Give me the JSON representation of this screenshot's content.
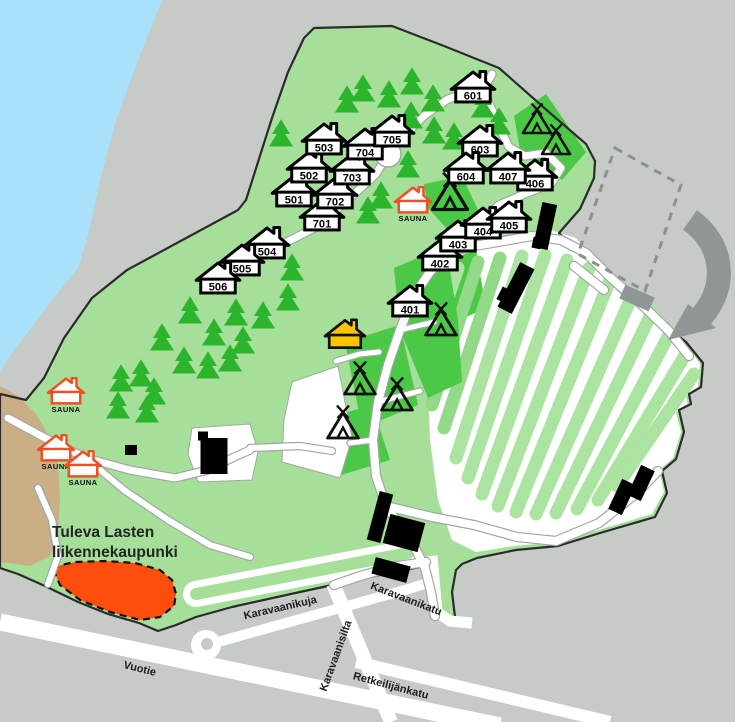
{
  "map": {
    "width": 735,
    "height": 722,
    "colors": {
      "land": "#c6cbc8",
      "water": "#a9e1fb",
      "camp": "#a5df9a",
      "plot": "#4cc847",
      "island": "#abe3a0",
      "island_alt": "#92da88",
      "tree": "#2cb52c",
      "road": "#ffffff",
      "casing": "#a0a8a0",
      "boundary": "#2b2b2b",
      "building": "#000000",
      "beach": "#c9ae86",
      "sauna": "#f04f21",
      "reception": "#fcc400",
      "zone": "#fe4e0e",
      "gray_structure": "#8f9693",
      "dashed": "#8a918e"
    },
    "labels": {
      "sauna": "SAUNA",
      "area": [
        "Tuleva Lasten",
        "liikennekaupunki"
      ],
      "area_x": 52,
      "area_y": 537,
      "area_line_height": 20
    },
    "streets": [
      {
        "name": "Karavaanikuja",
        "x": 281,
        "y": 611,
        "rot": -13
      },
      {
        "name": "Karavaanikatu",
        "x": 405,
        "y": 602,
        "rot": 21
      },
      {
        "name": "Karavaanisilta",
        "x": 339,
        "y": 657,
        "rot": -70
      },
      {
        "name": "Vuotie",
        "x": 139,
        "y": 672,
        "rot": 14
      },
      {
        "name": "Retkeilijänkatu",
        "x": 390,
        "y": 689,
        "rot": 15
      }
    ],
    "cabins": [
      {
        "n": "501",
        "x": 294,
        "y": 191
      },
      {
        "n": "502",
        "x": 309,
        "y": 167
      },
      {
        "n": "503",
        "x": 324,
        "y": 139
      },
      {
        "n": "504",
        "x": 267,
        "y": 243
      },
      {
        "n": "505",
        "x": 242,
        "y": 260
      },
      {
        "n": "506",
        "x": 218,
        "y": 278
      },
      {
        "n": "701",
        "x": 322,
        "y": 215
      },
      {
        "n": "702",
        "x": 335,
        "y": 193
      },
      {
        "n": "703",
        "x": 352,
        "y": 169
      },
      {
        "n": "704",
        "x": 365,
        "y": 144
      },
      {
        "n": "705",
        "x": 392,
        "y": 131
      },
      {
        "n": "601",
        "x": 473,
        "y": 87
      },
      {
        "n": "603",
        "x": 480,
        "y": 141
      },
      {
        "n": "604",
        "x": 466,
        "y": 168
      },
      {
        "n": "401",
        "x": 410,
        "y": 301
      },
      {
        "n": "402",
        "x": 440,
        "y": 255
      },
      {
        "n": "403",
        "x": 458,
        "y": 236
      },
      {
        "n": "404",
        "x": 483,
        "y": 223
      },
      {
        "n": "405",
        "x": 509,
        "y": 217
      },
      {
        "n": "406",
        "x": 535,
        "y": 175
      },
      {
        "n": "407",
        "x": 508,
        "y": 168
      }
    ],
    "saunas": [
      {
        "x": 413,
        "y": 200
      },
      {
        "x": 66,
        "y": 391
      },
      {
        "x": 56,
        "y": 448
      },
      {
        "x": 83,
        "y": 464
      }
    ],
    "reception": {
      "x": 345,
      "y": 334
    },
    "tents": [
      [
        537,
        123,
        1.0
      ],
      [
        556,
        144,
        1.0
      ],
      [
        450,
        197,
        1.25
      ],
      [
        441,
        324,
        1.1
      ],
      [
        360,
        383,
        1.1
      ],
      [
        397,
        399,
        1.1
      ],
      [
        343,
        427,
        1.1
      ]
    ],
    "trees": [
      [
        347,
        101
      ],
      [
        363,
        90
      ],
      [
        389,
        96
      ],
      [
        412,
        83
      ],
      [
        433,
        100
      ],
      [
        411,
        117
      ],
      [
        434,
        132
      ],
      [
        454,
        138
      ],
      [
        470,
        158
      ],
      [
        408,
        166
      ],
      [
        381,
        197
      ],
      [
        368,
        212
      ],
      [
        483,
        106
      ],
      [
        499,
        123
      ],
      [
        281,
        135
      ],
      [
        292,
        269
      ],
      [
        288,
        299
      ],
      [
        263,
        317
      ],
      [
        236,
        314
      ],
      [
        190,
        312
      ],
      [
        162,
        339
      ],
      [
        214,
        334
      ],
      [
        243,
        342
      ],
      [
        121,
        380
      ],
      [
        141,
        375
      ],
      [
        154,
        393
      ],
      [
        118,
        407
      ],
      [
        147,
        411
      ],
      [
        184,
        362
      ],
      [
        208,
        367
      ],
      [
        230,
        360
      ]
    ],
    "geometry": {
      "water": "0,0 162,0 140,55 116,120 100,180 88,235 78,268 52,300 28,332 10,355 0,372",
      "camp": "0,568 0,394 26,400 44,378 64,338 92,298 127,270 238,210 246,200 258,162 272,118 288,72 304,38 314,28 392,26 444,46 499,68 550,113 586,144 595,161 594,178 580,209 559,233 592,264 620,291 662,323 686,342 703,363 701,387 689,394 691,404 679,410 684,432 676,459 662,471 667,493 655,517 600,533 558,546 516,550 477,558 462,564 456,570 452,592 455,617 448,623 441,616 434,592 436,574 420,567 360,579 300,592 232,607 196,617 176,625 158,631 139,623 108,614 78,602 45,586 18,574",
      "beach": "0,386 18,396 36,414 50,438 58,465 60,498 58,532 50,556 30,566 0,562",
      "field": "446,260 545,228 576,238 618,292 660,324 686,344 700,364 698,388 686,396 688,406 676,412 681,432 673,458 659,470 664,492 652,514 598,530 556,542 514,546 476,552 452,540 438,500 430,440 428,380 432,320",
      "field_plot": "432,266 476,250 486,308 438,330",
      "plots": [
        "424,184 462,176 480,214 448,230 428,208",
        "514,116 546,94 586,152 562,180 520,150",
        "394,268 446,246 458,320 462,382 428,398 400,330",
        "345,342 400,325 418,405 362,428",
        "320,420 372,405 390,460 338,476 318,452"
      ],
      "white_areas": [
        "292,382 338,366 352,438 340,478 282,462 284,420",
        "192,428 250,424 258,452 252,480 198,482 188,454"
      ],
      "islands": [
        [
          430,
          350,
          458,
          268
        ],
        [
          432,
          405,
          478,
          262
        ],
        [
          444,
          428,
          500,
          258
        ],
        [
          456,
          458,
          522,
          256
        ],
        [
          468,
          478,
          545,
          255
        ],
        [
          482,
          494,
          567,
          260
        ],
        [
          498,
          506,
          589,
          268
        ],
        [
          516,
          512,
          610,
          280
        ],
        [
          536,
          514,
          632,
          296
        ],
        [
          556,
          513,
          652,
          312
        ],
        [
          577,
          509,
          671,
          331
        ],
        [
          598,
          500,
          687,
          352
        ],
        [
          617,
          486,
          694,
          374
        ]
      ],
      "island_alt_index": [
        1,
        2
      ],
      "ext_roads": [
        {
          "d": "M 0,622 L 500,726",
          "w": 17
        },
        {
          "d": "M 333,584 L 391,722",
          "w": 14
        },
        {
          "d": "M 356,662 L 610,722",
          "w": 12
        },
        {
          "d": "M 432,556 L 437,612 L 450,621 L 472,623",
          "w": 11
        },
        {
          "d": "M 207,645 L 268,628 L 340,608 L 405,590 L 428,583",
          "w": 10
        }
      ],
      "loop": {
        "cx": 206,
        "cy": 645,
        "r": 15,
        "hole_cx": 207,
        "hole_cy": 644,
        "hole_r": 6
      },
      "paths": [
        {
          "d": "M 388,154 L 376,174 L 352,196 L 318,226 L 285,243 L 252,262 L 231,274",
          "w": 7
        },
        {
          "d": "M 492,74 L 483,90 L 470,92 L 448,99 L 425,115 L 404,136 L 388,154",
          "w": 7
        },
        {
          "d": "M 483,90 L 492,110 L 501,131 L 509,147 L 525,156 L 546,153 L 561,168 L 551,184 L 527,193 L 499,205 L 473,227 L 450,250",
          "w": 7
        },
        {
          "d": "M 450,250 L 430,272 L 413,297 L 400,330 L 388,365 L 378,402 L 373,440 L 376,476 L 386,506 L 401,527 L 415,548 L 425,568 L 431,592 L 435,616",
          "w": 8
        },
        {
          "d": "M 450,250 L 492,243 L 532,236 L 561,240 L 586,253 L 612,279 L 641,304 L 669,331 L 689,356",
          "w": 8
        },
        {
          "d": "M 386,506 L 432,517 L 474,525 L 517,537 L 556,541 L 599,523 L 637,493 L 658,471",
          "w": 8
        },
        {
          "d": "M 426,562 L 391,567 L 357,577 L 334,585",
          "w": 8
        },
        {
          "d": "M 8,418 L 45,438 L 86,458 L 130,470 L 175,478 L 208,470 L 232,458 L 250,450",
          "w": 7
        },
        {
          "d": "M 86,458 L 124,490 L 168,520 L 210,545 L 250,557",
          "w": 6
        },
        {
          "d": "M 38,488 L 52,520 L 58,556 L 48,584",
          "w": 6
        },
        {
          "d": "M 250,448 L 300,446 L 332,451",
          "w": 6
        },
        {
          "d": "M 336,361 L 360,354 L 379,352",
          "w": 5
        },
        {
          "d": "M 574,266 L 604,290",
          "w": 8
        },
        {
          "d": "M 373,440 L 350,443",
          "w": 5
        },
        {
          "d": "M 378,402 L 420,391",
          "w": 5
        },
        {
          "d": "M 400,330 L 434,322",
          "w": 5
        }
      ],
      "junction_circle": {
        "cx": 388,
        "cy": 154,
        "r": 13
      },
      "oval": {
        "d": "M 196,594 L 408,553",
        "outer_w": 26,
        "inner_w": 12
      },
      "zone": "52,567 75,562 105,561 135,563 160,570 172,580 176,594 174,606 160,617 140,620 110,612 80,600 60,585",
      "buildings": [
        [
          545,
          226,
          15,
          46,
          12
        ],
        [
          537,
          243,
          9,
          11,
          12
        ],
        [
          516,
          288,
          16,
          50,
          27
        ],
        [
          504,
          295,
          10,
          14,
          27
        ],
        [
          380,
          517,
          14,
          50,
          15
        ],
        [
          404,
          533,
          36,
          30,
          15
        ],
        [
          391,
          570,
          36,
          17,
          15
        ],
        [
          622,
          497,
          15,
          33,
          25
        ],
        [
          641,
          483,
          15,
          33,
          25
        ],
        [
          214,
          456,
          27,
          36,
          0
        ],
        [
          203,
          436,
          10,
          9,
          0
        ],
        [
          131,
          450,
          12,
          10,
          0
        ]
      ],
      "dashed_rect": "615,148 681,185 645,291 578,254",
      "gray_rect": [
        637,
        298,
        32,
        15,
        24
      ],
      "arrow_band": "M 690,220 C 724,244 728,286 702,316",
      "arrow_band_w": 24,
      "arrow_head": "716,328 688,304 668,340"
    }
  }
}
